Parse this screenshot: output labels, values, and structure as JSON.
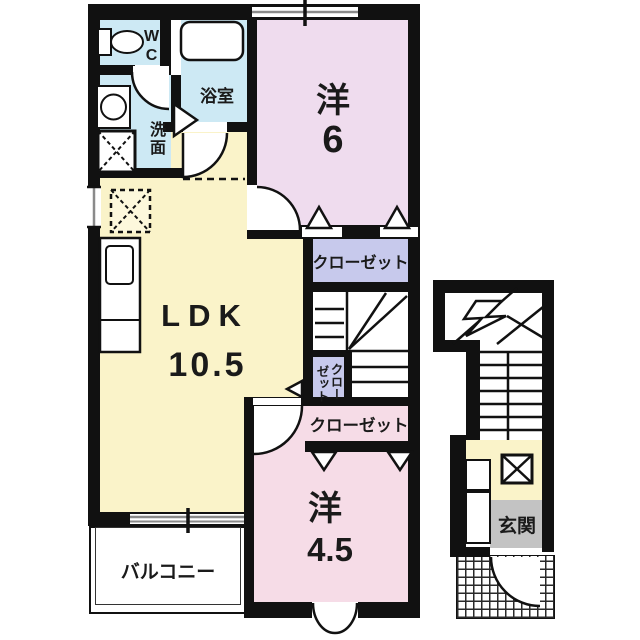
{
  "floor_plan": {
    "rooms": {
      "wc": {
        "label": "WC"
      },
      "bathroom": {
        "label": "浴室"
      },
      "washroom": {
        "label": "洗面"
      },
      "western_room_6": {
        "kanji": "洋",
        "size": "6"
      },
      "ldk": {
        "label": "LDK",
        "size": "10.5"
      },
      "closet_top": {
        "label": "クローゼット"
      },
      "closet_middle": {
        "col_right": "クロー",
        "col_left": "ゼット"
      },
      "closet_bottom": {
        "label": "クローゼット"
      },
      "western_room_45": {
        "kanji": "洋",
        "size": "4.5"
      },
      "balcony": {
        "label": "バルコニー"
      },
      "entrance": {
        "label": "玄関"
      }
    },
    "colors": {
      "wall": "#111111",
      "sanitary_blue": "#cde9f4",
      "room6_pink": "#efdcee",
      "room45_pink": "#f6dce7",
      "ldk_yellow": "#faf3c9",
      "closet_lavender": "#c7c9ec",
      "entrance_gray": "#c3c3c3"
    }
  }
}
